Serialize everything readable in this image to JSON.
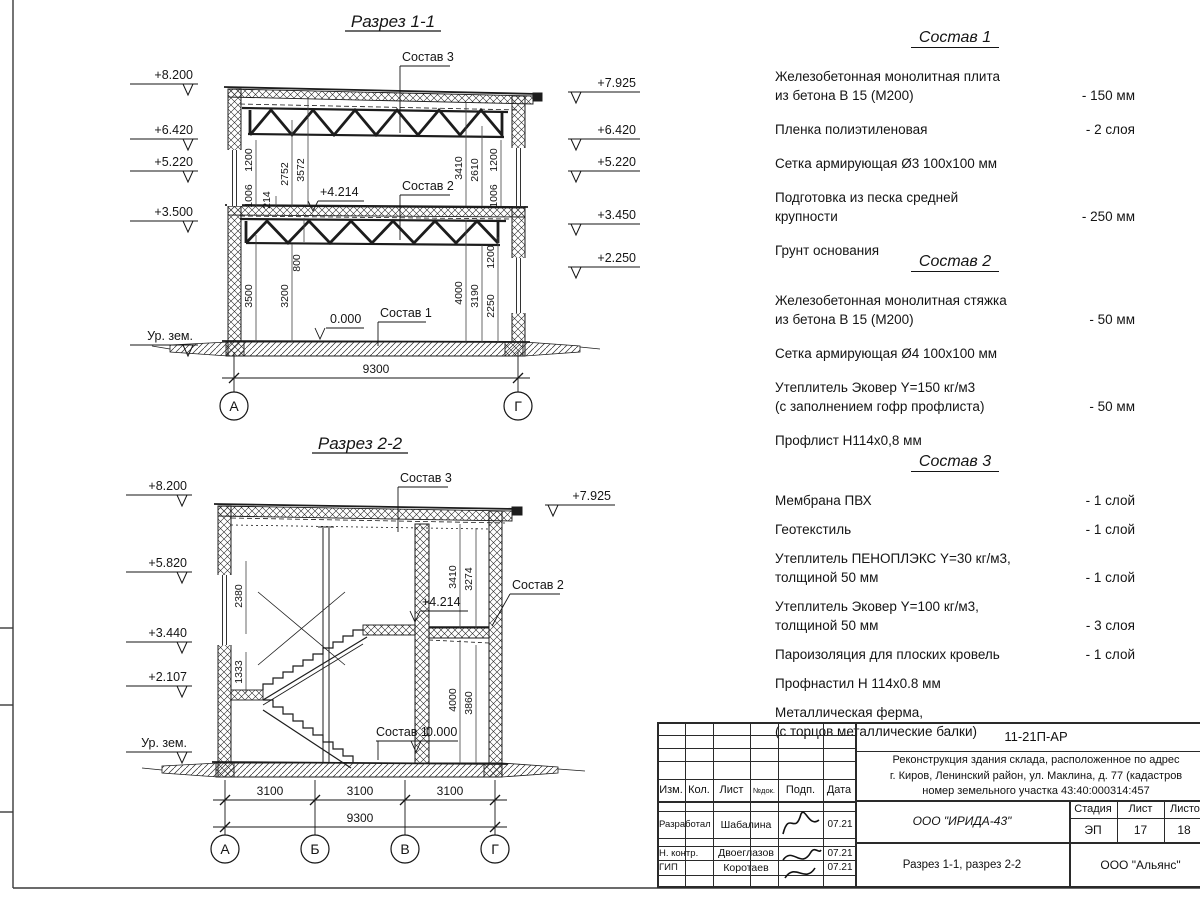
{
  "s1": {
    "title": "Разрез 1-1",
    "elev_left": [
      "+8.200",
      "+6.420",
      "+5.220",
      "+3.500",
      "Ур. зем."
    ],
    "elev_right": [
      "+7.925",
      "+6.420",
      "+5.220",
      "+3.450",
      "+2.250"
    ],
    "dims": {
      "d1200a": "1200",
      "d1006a": "1006",
      "d214": "214",
      "d2752": "2752",
      "d3572": "3572",
      "d3410": "3410",
      "d2610": "2610",
      "d1200b": "1200",
      "d1006b": "1006",
      "d800": "800",
      "d3500": "3500",
      "d3200": "3200",
      "d4000": "4000",
      "d3190": "3190",
      "d2250": "2250",
      "d1200c": "1200",
      "total": "9300"
    },
    "marks": {
      "lvl4214": "+4.214",
      "lvl0": "0.000"
    },
    "callouts": {
      "c3": "Состав 3",
      "c2": "Состав 2",
      "c1": "Состав 1"
    },
    "axes": [
      "А",
      "Г"
    ]
  },
  "s2": {
    "title": "Разрез 2-2",
    "elev_left": [
      "+8.200",
      "+5.820",
      "+3.440",
      "+2.107",
      "Ур. зем."
    ],
    "elev_right": [
      "+7.925"
    ],
    "dims": {
      "d2380": "2380",
      "d1333": "1333",
      "d3410": "3410",
      "d3274": "3274",
      "d4000": "4000",
      "d3860": "3860",
      "d3100a": "3100",
      "d3100b": "3100",
      "d3100c": "3100",
      "total": "9300"
    },
    "marks": {
      "lvl4214": "+4.214",
      "lvl0": "0.000"
    },
    "callouts": {
      "c3": "Состав 3",
      "c2": "Состав 2",
      "c1": "Состав 1"
    },
    "axes": [
      "А",
      "Б",
      "В",
      "Г"
    ]
  },
  "comp1": {
    "title": "Состав 1",
    "items": [
      {
        "l1": "Железобетонная  монолитная плита",
        "l2": "из бетона В 15 (М200)",
        "v": "- 150 мм"
      },
      {
        "l1": "Пленка полиэтиленовая",
        "l2": "",
        "v": "-  2 слоя"
      },
      {
        "l1": "Сетка армирующая Ø3 100х100 мм",
        "l2": "",
        "v": ""
      },
      {
        "l1": "Подготовка из песка средней",
        "l2": "крупности",
        "v": "- 250 мм"
      },
      {
        "l1": "Грунт основания",
        "l2": "",
        "v": ""
      }
    ]
  },
  "comp2": {
    "title": "Состав 2",
    "items": [
      {
        "l1": "Железобетонная  монолитная стяжка",
        "l2": "из бетона В 15 (М200)",
        "v": "- 50 мм"
      },
      {
        "l1": "Сетка армирующая Ø4 100х100 мм",
        "l2": "",
        "v": ""
      },
      {
        "l1": "Утеплитель Эковер Y=150 кг/м3",
        "l2": "(с заполнением гофр профлиста)",
        "v": "- 50 мм"
      },
      {
        "l1": "Профлист Н114х0,8 мм",
        "l2": "",
        "v": ""
      }
    ]
  },
  "comp3": {
    "title": "Состав 3",
    "items": [
      {
        "l1": "Мембрана ПВХ",
        "l2": "",
        "v": "- 1 слой"
      },
      {
        "l1": "Геотекстиль",
        "l2": "",
        "v": "- 1 слой"
      },
      {
        "l1": "Утеплитель ПЕНОПЛЭКС Y=30 кг/м3,",
        "l2": "толщиной 50 мм",
        "v": "- 1 слой"
      },
      {
        "l1": "Утеплитель Эковер Y=100 кг/м3,",
        "l2": "толщиной 50 мм",
        "v": "- 3 слоя"
      },
      {
        "l1": "Пароизоляция для плоских кровель",
        "l2": "",
        "v": "- 1 слой"
      },
      {
        "l1": "Профнастил Н 114х0.8 мм",
        "l2": "",
        "v": ""
      },
      {
        "l1": "Металлическая ферма,",
        "l2": "(с торцов металлические балки)",
        "v": ""
      }
    ]
  },
  "tb": {
    "doc_code": "11-21П-АР",
    "desc1": "Реконструкция здания склада, расположенное по адрес",
    "desc2": "г. Киров, Ленинский район, ул. Маклина, д. 77 (кадастров",
    "desc3": "номер земельного участка 43:40:000314:457",
    "cols": {
      "izm": "Изм.",
      "kol": "Кол.",
      "list": "Лист",
      "ndok": "№док.",
      "podp": "Подп.",
      "data": "Дата"
    },
    "rows": [
      {
        "role": "Разработал",
        "name": "Шабалина",
        "date": "07.21"
      },
      {
        "role": "Н. контр.",
        "name": "Двоеглазов",
        "date": "07.21"
      },
      {
        "role": "ГИП",
        "name": "Коротаев",
        "date": "07.21"
      }
    ],
    "org": "ООО \"ИРИДА-43\"",
    "stage_label": "Стадия",
    "sheet_label": "Лист",
    "sheets_label": "Листов",
    "stage": "ЭП",
    "sheet_no": "17",
    "sheets_total": "18",
    "sheet_title": "Разрез 1-1, разрез 2-2",
    "contractor": "ООО \"Альянс\""
  }
}
